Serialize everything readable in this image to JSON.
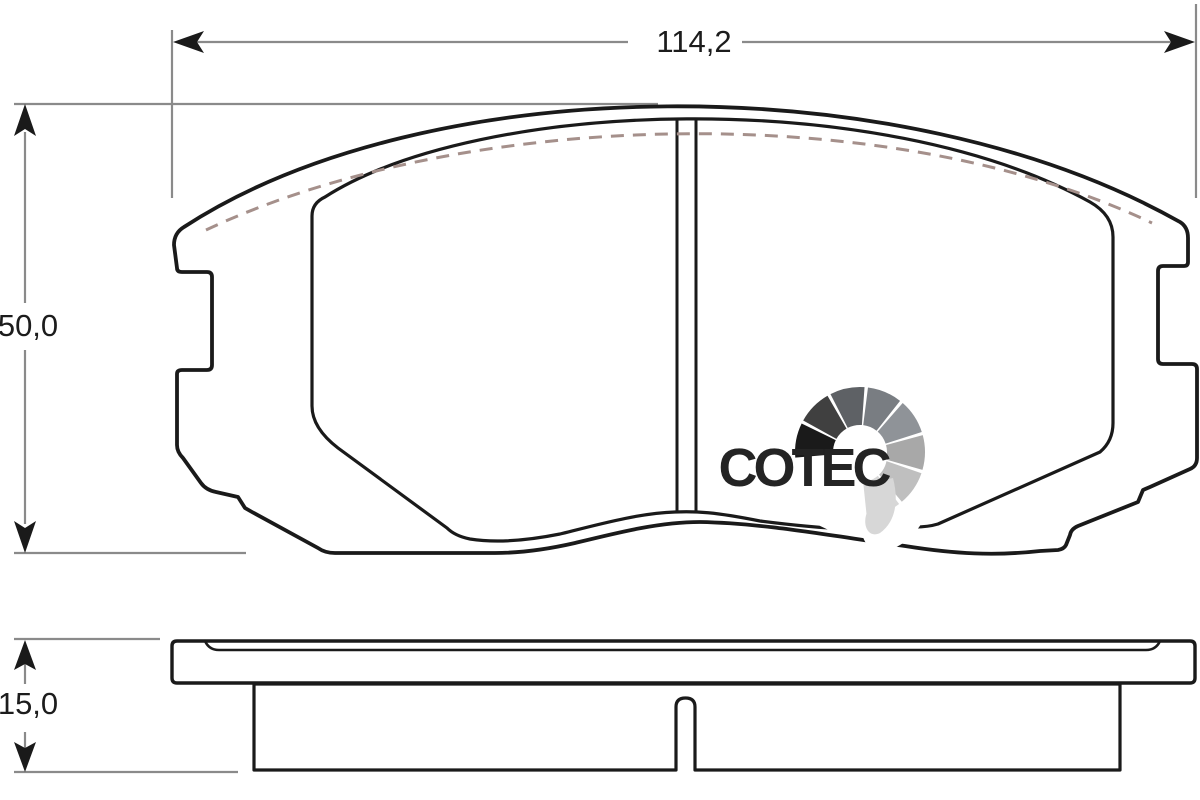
{
  "drawing": {
    "description": "Technical outline drawing of a disc brake pad shown in front view and side (edge) view with friction material, centre wear groove and dimension callouts",
    "views": {
      "front": "front-view",
      "side": "side-view"
    }
  },
  "dimensions": {
    "width": "114,2",
    "height": "50,0",
    "thickness": "15,0"
  },
  "logo": {
    "text": "COTEC"
  },
  "colors": {
    "friction_material": "#f8b29b",
    "outline": "#1a1a1a",
    "dimension_lines": "#8a8a8a",
    "chamfer_dash": "#a5908b",
    "logo_text": "#242424",
    "logo_fan": [
      "#1a1a1a",
      "#404040",
      "#5e6165",
      "#797d82",
      "#8f9398",
      "#a8a8a8",
      "#bfbfbf",
      "#d7d7d7"
    ]
  }
}
